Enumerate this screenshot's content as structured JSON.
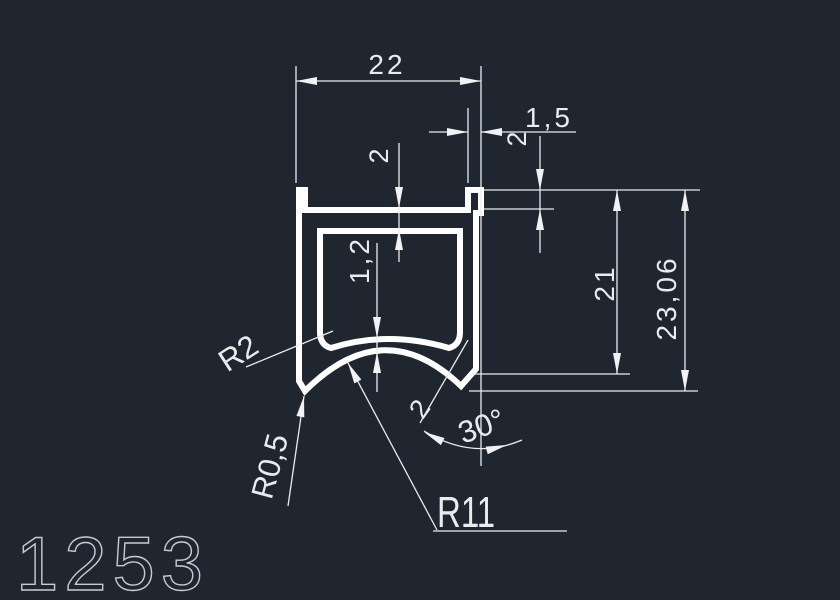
{
  "drawing": {
    "profile_number": "1253",
    "type_note": "CAD cross-section drawing of extrusion profile",
    "dimensions": {
      "overall_width": "22",
      "lip_width": "1,5",
      "lip_height": "2",
      "top_wall_thickness": "2",
      "arch_wall_thickness": "1,2",
      "inner_height": "21",
      "overall_height": "23,06",
      "corner_radius": "R2",
      "tip_radius": "R0,5",
      "arch_radius": "R11",
      "chamfer_length": "2",
      "chamfer_angle": "30°"
    },
    "colors": {
      "background": "#20262f",
      "profile_line": "#ffffff",
      "dimension_line": "#e9ecef",
      "title_text": "#c6cbd2"
    }
  }
}
